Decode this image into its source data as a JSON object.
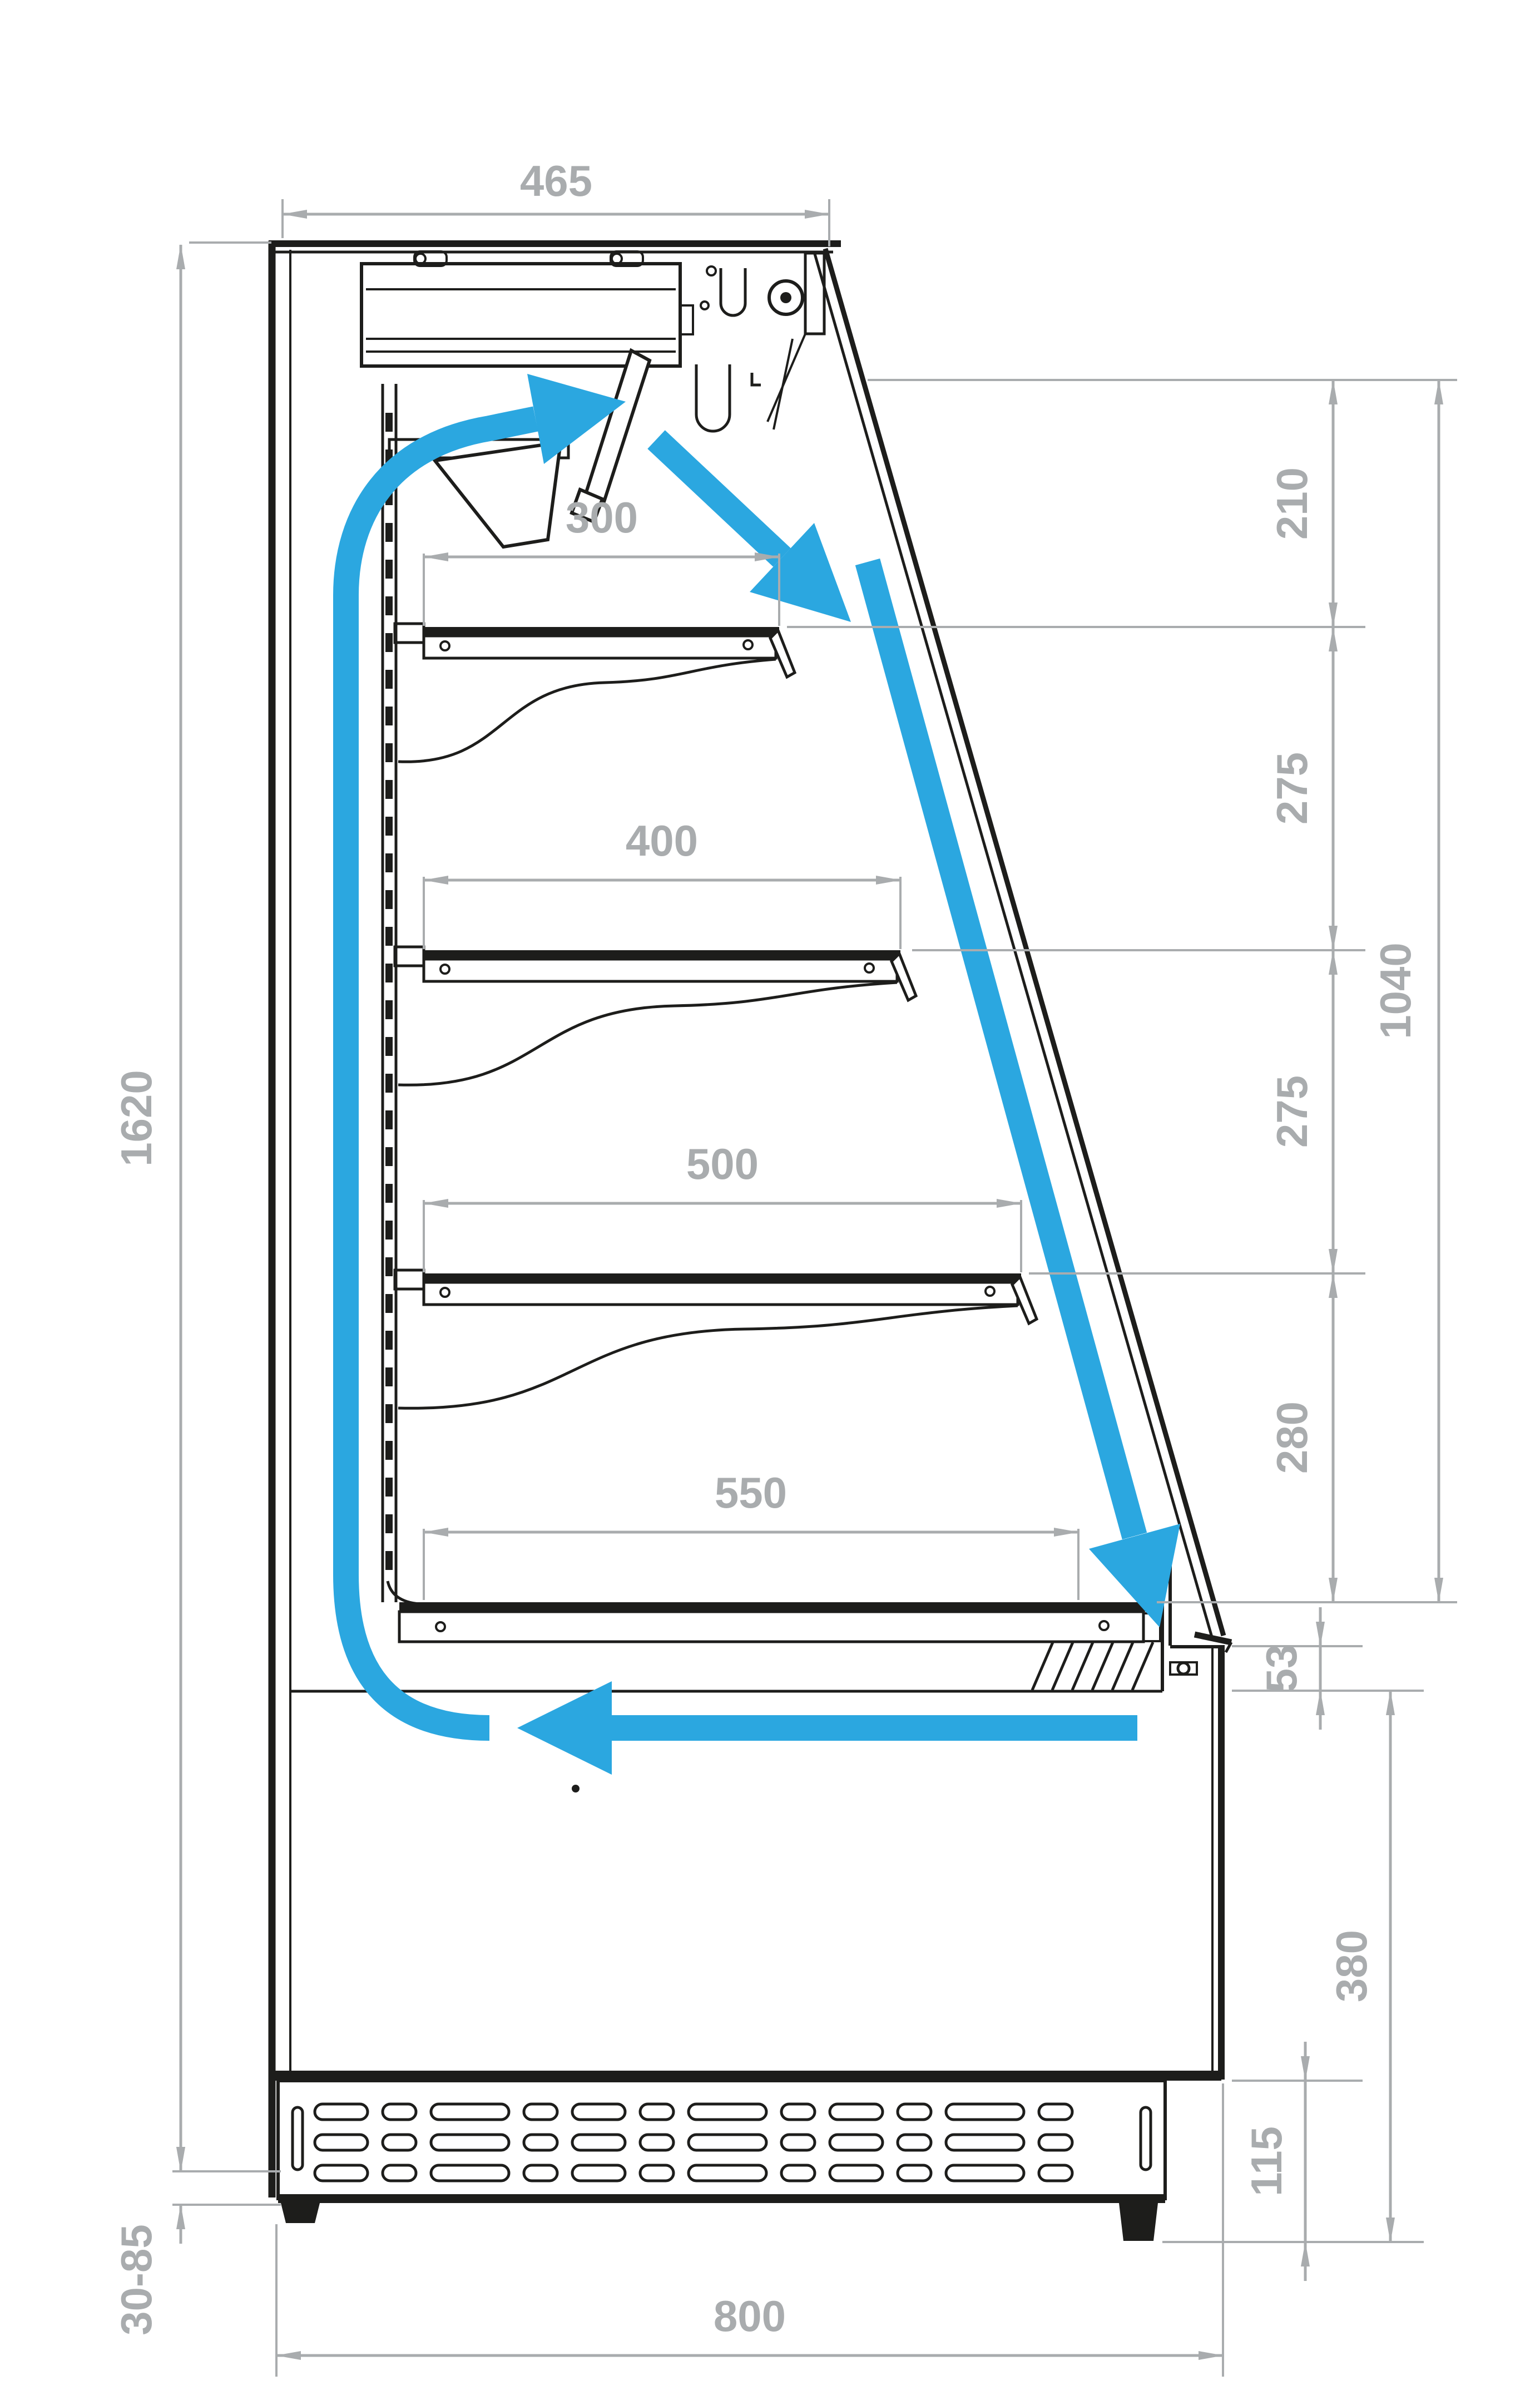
{
  "diagram": {
    "type": "technical-drawing",
    "subject": "refrigerated-display-case-cross-section-with-airflow",
    "colors": {
      "line": "#1d1d1b",
      "dimension": "#a9acae",
      "airflow": "#2ba7e0",
      "background": "#ffffff"
    },
    "dimensions": {
      "top_width": "465",
      "right_gap_top": "210",
      "right_shelf_gap_1": "275",
      "right_shelf_gap_2": "275",
      "right_gap_bottom": "280",
      "right_total": "1040",
      "front_edge": "53",
      "base_front_height": "380",
      "plinth_height": "115",
      "overall_height": "1620",
      "feet_range": "30-85",
      "base_depth": "800",
      "shelf_1_depth": "300",
      "shelf_2_depth": "400",
      "shelf_3_depth": "500",
      "shelf_4_depth": "550"
    }
  }
}
